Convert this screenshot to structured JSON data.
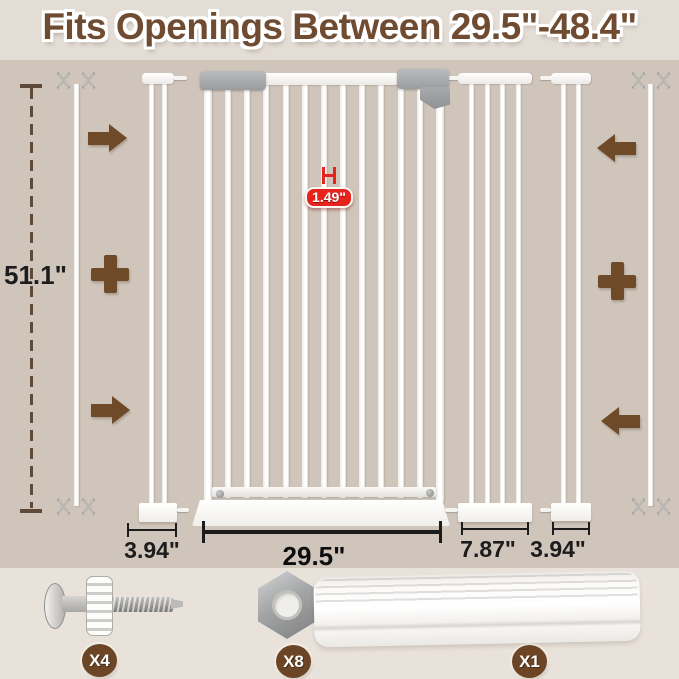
{
  "title": "Fits Openings Between 29.5\"-48.4\"",
  "diagram": {
    "height_label": "51.1\"",
    "bar_gap_label": "1.49\"",
    "widths": {
      "small_extension_left": "3.94\"",
      "gate": "29.5\"",
      "large_extension": "7.87\"",
      "small_extension_right": "3.94\""
    },
    "structure": {
      "gate_inner_bars": 11,
      "large_extension_bars": 4,
      "small_extension_left_bars": 2,
      "small_extension_right_bars": 2
    }
  },
  "hardware": {
    "items": [
      {
        "name": "pressure-mount spindle screw",
        "count_label": "X4"
      },
      {
        "name": "hex nut",
        "count_label": "X8"
      },
      {
        "name": "wall protector pad",
        "count_label": "X1"
      }
    ]
  },
  "colors": {
    "header_bg": "#e4ddd6",
    "main_bg": "#cfc5bb",
    "footer_bg": "#e9e2db",
    "title_brown": "#6f4b31",
    "accent_brown": "#6f4a28",
    "badge_brown": "#6b4526",
    "badge_red": "#e6231c",
    "metal_gray": "#a9abad",
    "text_dark": "#1c1c1c"
  }
}
